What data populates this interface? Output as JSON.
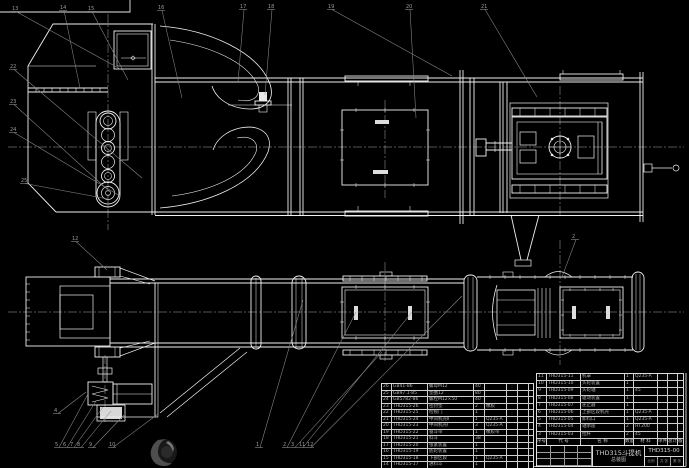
{
  "canvas": {
    "background": "#000000",
    "main_line_color": "#f0f0f0",
    "leader_color": "#8c8c8c",
    "centerline_color": "#cfcfcf"
  },
  "title_block": {
    "product": "THD315斗提机",
    "sheet_name": "总装图",
    "drawing_no": "THD315-00",
    "info_cells": [
      "比例",
      "共 张",
      "第 张"
    ]
  },
  "bom_header_cells": [
    "序号",
    "代 号",
    "名 称",
    "数量",
    "材 料",
    "单件",
    "总计",
    "备注"
  ],
  "bom_left_rows": [
    [
      "26",
      "GB41-86",
      "螺母M12",
      "40",
      "",
      "",
      "",
      ""
    ],
    [
      "25",
      "GB97.1-85",
      "垫圈12",
      "80",
      "",
      "",
      "",
      ""
    ],
    [
      "24",
      "GB5782-86",
      "螺栓M12×50",
      "40",
      "",
      "",
      "",
      ""
    ],
    [
      "23",
      "THD315-26",
      "密封垫",
      "2",
      "橡胶",
      "",
      "",
      ""
    ],
    [
      "22",
      "THD315-25",
      "检视门",
      "1",
      "",
      "",
      "",
      ""
    ],
    [
      "21",
      "THD315-24",
      "中间机壳Ⅱ",
      "1",
      "Q235-A",
      "",
      "",
      ""
    ],
    [
      "20",
      "THD315-23",
      "中间机壳Ⅰ",
      "3",
      "Q235-A",
      "",
      "",
      ""
    ],
    [
      "19",
      "THD315-22",
      "畚斗带",
      "1",
      "橡胶带",
      "",
      "",
      ""
    ],
    [
      "18",
      "THD315-21",
      "料斗",
      "38",
      "",
      "",
      "",
      ""
    ],
    [
      "17",
      "THD315-20",
      "张紧装置",
      "1",
      "",
      "",
      "",
      ""
    ],
    [
      "16",
      "THD315-19",
      "底轮装置",
      "1",
      "",
      "",
      "",
      ""
    ],
    [
      "15",
      "THD315-18",
      "下部区段",
      "1",
      "Q235-A",
      "",
      "",
      ""
    ],
    [
      "14",
      "THD315-17",
      "进料斗",
      "1",
      "",
      "",
      "",
      ""
    ]
  ],
  "bom_right_rows": [
    [
      "11",
      "THD315-11",
      "机罩",
      "1",
      "Q235-A",
      "",
      "",
      ""
    ],
    [
      "10",
      "THD315-10",
      "头轮装置",
      "1",
      "",
      "",
      "",
      ""
    ],
    [
      "9",
      "THD315-09",
      "头轮轴",
      "1",
      "45",
      "",
      "",
      ""
    ],
    [
      "8",
      "THD315-08",
      "驱动装置",
      "1",
      "",
      "",
      "",
      ""
    ],
    [
      "7",
      "THD315-07",
      "逆止器",
      "1",
      "",
      "",
      "",
      ""
    ],
    [
      "6",
      "THD315-06",
      "上部区段机壳",
      "1",
      "Q235-A",
      "",
      "",
      ""
    ],
    [
      "5",
      "THD315-05",
      "卸料口",
      "1",
      "Q235-A",
      "",
      "",
      ""
    ],
    [
      "4",
      "THD315-04",
      "轴承座",
      "2",
      "HT200",
      "",
      "",
      ""
    ],
    [
      "3",
      "THD315-03",
      "拉杆",
      "2",
      "45",
      "",
      "",
      ""
    ]
  ],
  "callouts": {
    "top": [
      {
        "n": "13",
        "x": 14,
        "y": 10,
        "tx": 122,
        "ty": 70
      },
      {
        "n": "14",
        "x": 62,
        "y": 9,
        "tx": 80,
        "ty": 88
      },
      {
        "n": "15",
        "x": 90,
        "y": 10,
        "tx": 128,
        "ty": 80
      },
      {
        "n": "16",
        "x": 160,
        "y": 9,
        "tx": 182,
        "ty": 98
      },
      {
        "n": "17",
        "x": 242,
        "y": 8,
        "tx": 238,
        "ty": 82
      },
      {
        "n": "18",
        "x": 270,
        "y": 8,
        "tx": 265,
        "ty": 95
      },
      {
        "n": "19",
        "x": 330,
        "y": 8,
        "tx": 452,
        "ty": 76
      },
      {
        "n": "20",
        "x": 408,
        "y": 8,
        "tx": 416,
        "ty": 118
      },
      {
        "n": "21",
        "x": 483,
        "y": 8,
        "tx": 537,
        "ty": 97
      }
    ],
    "left": [
      {
        "n": "22",
        "x": 12,
        "y": 68,
        "tx": 142,
        "ty": 178
      },
      {
        "n": "23",
        "x": 12,
        "y": 103,
        "tx": 108,
        "ty": 190
      },
      {
        "n": "24",
        "x": 12,
        "y": 131,
        "tx": 120,
        "ty": 196
      },
      {
        "n": "25",
        "x": 23,
        "y": 182,
        "tx": 108,
        "ty": 199
      }
    ],
    "bottom_view": [
      {
        "n": "12",
        "x": 74,
        "y": 240,
        "tx": 107,
        "ty": 270
      },
      {
        "n": "2",
        "x": 574,
        "y": 238,
        "tx": 562,
        "ty": 277
      }
    ],
    "bottom_left": [
      {
        "n": "5",
        "x": 57,
        "y": 446,
        "tx": 88,
        "ty": 394
      },
      {
        "n": "6",
        "x": 65,
        "y": 446,
        "tx": 96,
        "ty": 401
      },
      {
        "n": "7",
        "x": 72,
        "y": 446,
        "tx": 103,
        "ty": 407
      },
      {
        "n": "8",
        "x": 79,
        "y": 446,
        "tx": 111,
        "ty": 411
      },
      {
        "n": "9",
        "x": 91,
        "y": 446,
        "tx": 124,
        "ty": 415
      },
      {
        "n": "10",
        "x": 111,
        "y": 446,
        "tx": 158,
        "ty": 414
      },
      {
        "n": "4",
        "x": 56,
        "y": 412,
        "tx": 86,
        "ty": 392
      }
    ],
    "bottom_right": [
      {
        "n": "1",
        "x": 258,
        "y": 446,
        "tx": 303,
        "ty": 300
      },
      {
        "n": "2",
        "x": 285,
        "y": 446,
        "tx": 356,
        "ty": 312
      },
      {
        "n": "3",
        "x": 293,
        "y": 446,
        "tx": 382,
        "ty": 352
      },
      {
        "n": "11",
        "x": 301,
        "y": 446,
        "tx": 412,
        "ty": 312
      },
      {
        "n": "12",
        "x": 309,
        "y": 446,
        "tx": 462,
        "ty": 296
      }
    ]
  }
}
